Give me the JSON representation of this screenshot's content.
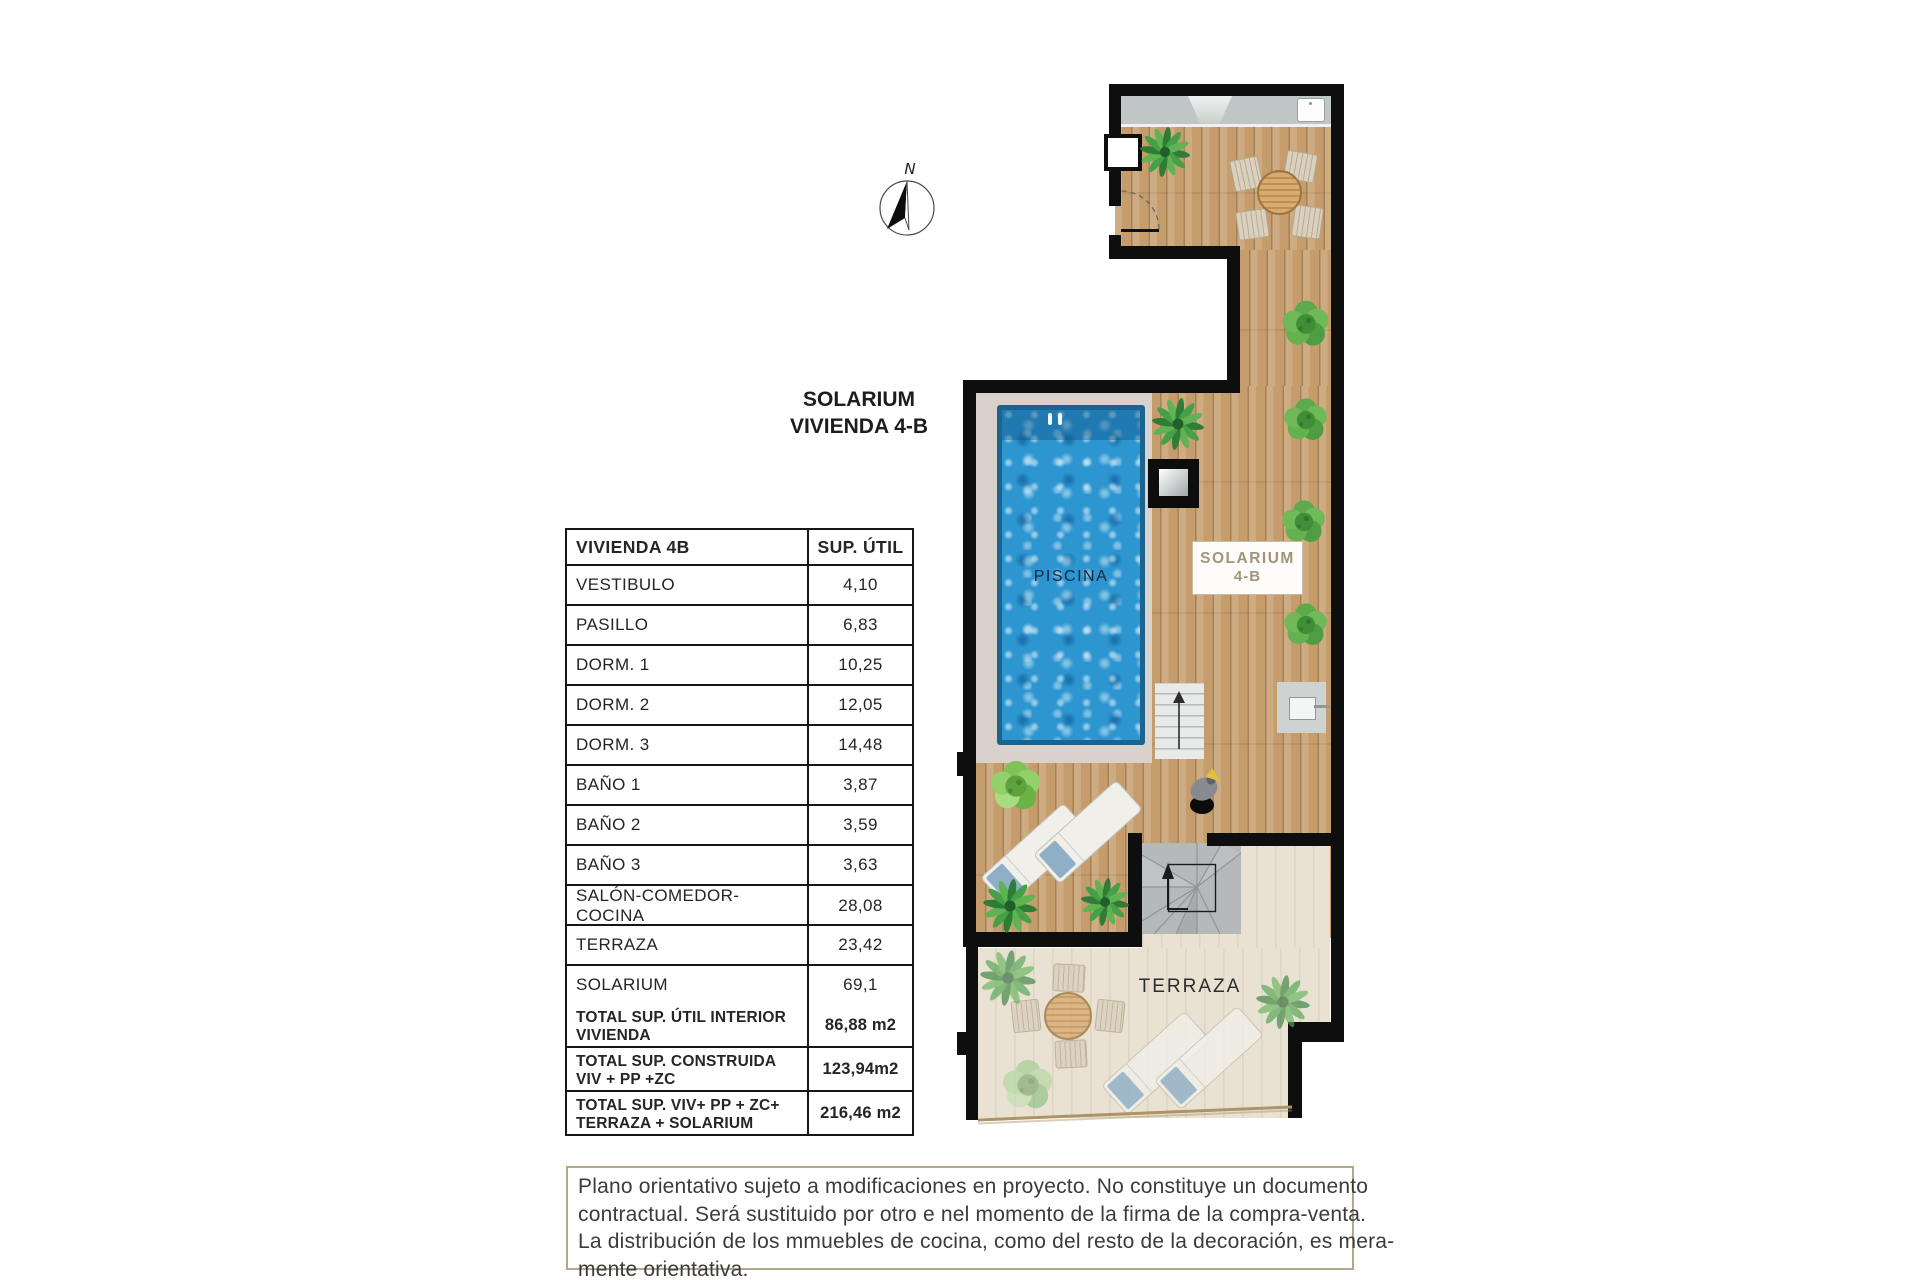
{
  "title": {
    "line1": "SOLARIUM",
    "line2": "VIVIENDA 4-B"
  },
  "compass": {
    "label": "N"
  },
  "table": {
    "header": {
      "col1": "VIVIENDA 4B",
      "col2": "SUP. ÚTIL"
    },
    "rows": [
      {
        "label": "VESTIBULO",
        "value": "4,10"
      },
      {
        "label": "PASILLO",
        "value": "6,83"
      },
      {
        "label": "DORM. 1",
        "value": "10,25"
      },
      {
        "label": "DORM. 2",
        "value": "12,05"
      },
      {
        "label": "DORM. 3",
        "value": "14,48"
      },
      {
        "label": "BAÑO 1",
        "value": "3,87"
      },
      {
        "label": "BAÑO 2",
        "value": "3,59"
      },
      {
        "label": "BAÑO 3",
        "value": "3,63"
      },
      {
        "label": "SALÓN-COMEDOR-COCINA",
        "value": "28,08"
      },
      {
        "label": "TERRAZA",
        "value": "23,42"
      },
      {
        "label": "SOLARIUM",
        "value": "69,1"
      }
    ],
    "totals": [
      {
        "label1": "TOTAL SUP. ÚTIL INTERIOR",
        "label2": "VIVIENDA",
        "value": "86,88 m2"
      },
      {
        "label1": "TOTAL SUP. CONSTRUIDA",
        "label2": "VIV + PP +ZC",
        "value": "123,94m2"
      },
      {
        "label1": "TOTAL SUP. VIV+ PP + ZC+",
        "label2": "TERRAZA + SOLARIUM",
        "value": "216,46 m2"
      }
    ]
  },
  "plan": {
    "labels": {
      "piscina": "PISCINA",
      "solarium_line1": "SOLARIUM",
      "solarium_line2": "4-B",
      "terraza": "TERRAZA"
    },
    "colors": {
      "wall": "#0e0e0e",
      "wood": "#c59c6b",
      "pool_water": "#2d95d0",
      "pool_border": "#1a648f",
      "pool_deck": "#d8d2ca",
      "terrace_floor": "#e9e2d3",
      "stairs": "#b6b9ba",
      "counter": "#bfc6c5",
      "label_tan": "#a29478",
      "disclaimer_border": "#b5a78c"
    },
    "plants": [
      {
        "type": "palm",
        "x": 1165,
        "y": 152,
        "r": 26,
        "dim": false
      },
      {
        "type": "bush",
        "x": 1306,
        "y": 324,
        "r": 27,
        "dim": false
      },
      {
        "type": "palm",
        "x": 1178,
        "y": 424,
        "r": 27,
        "dim": false
      },
      {
        "type": "bush",
        "x": 1306,
        "y": 420,
        "r": 25,
        "dim": false
      },
      {
        "type": "bush",
        "x": 1304,
        "y": 522,
        "r": 25,
        "dim": false
      },
      {
        "type": "bush",
        "x": 1306,
        "y": 625,
        "r": 25,
        "dim": false
      },
      {
        "type": "tree2",
        "x": 1016,
        "y": 786,
        "r": 29,
        "dim": false
      },
      {
        "type": "palm",
        "x": 1010,
        "y": 906,
        "r": 28,
        "dim": false
      },
      {
        "type": "palm",
        "x": 1105,
        "y": 902,
        "r": 25,
        "dim": false
      },
      {
        "type": "palm",
        "x": 1008,
        "y": 978,
        "r": 29,
        "dim": true
      },
      {
        "type": "palm",
        "x": 1283,
        "y": 1002,
        "r": 28,
        "dim": true
      },
      {
        "type": "tree",
        "x": 1028,
        "y": 1085,
        "r": 29,
        "dim": true
      }
    ]
  },
  "disclaimer": {
    "lines": [
      "Plano orientativo sujeto a modificaciones en proyecto. No constituye un documento",
      "contractual. Será sustituido por otro e nel momento de la firma de la compra-venta.",
      "La distribución de los mmuebles de cocina, como del resto de la decoración, es mera-",
      "mente orientativa."
    ]
  }
}
